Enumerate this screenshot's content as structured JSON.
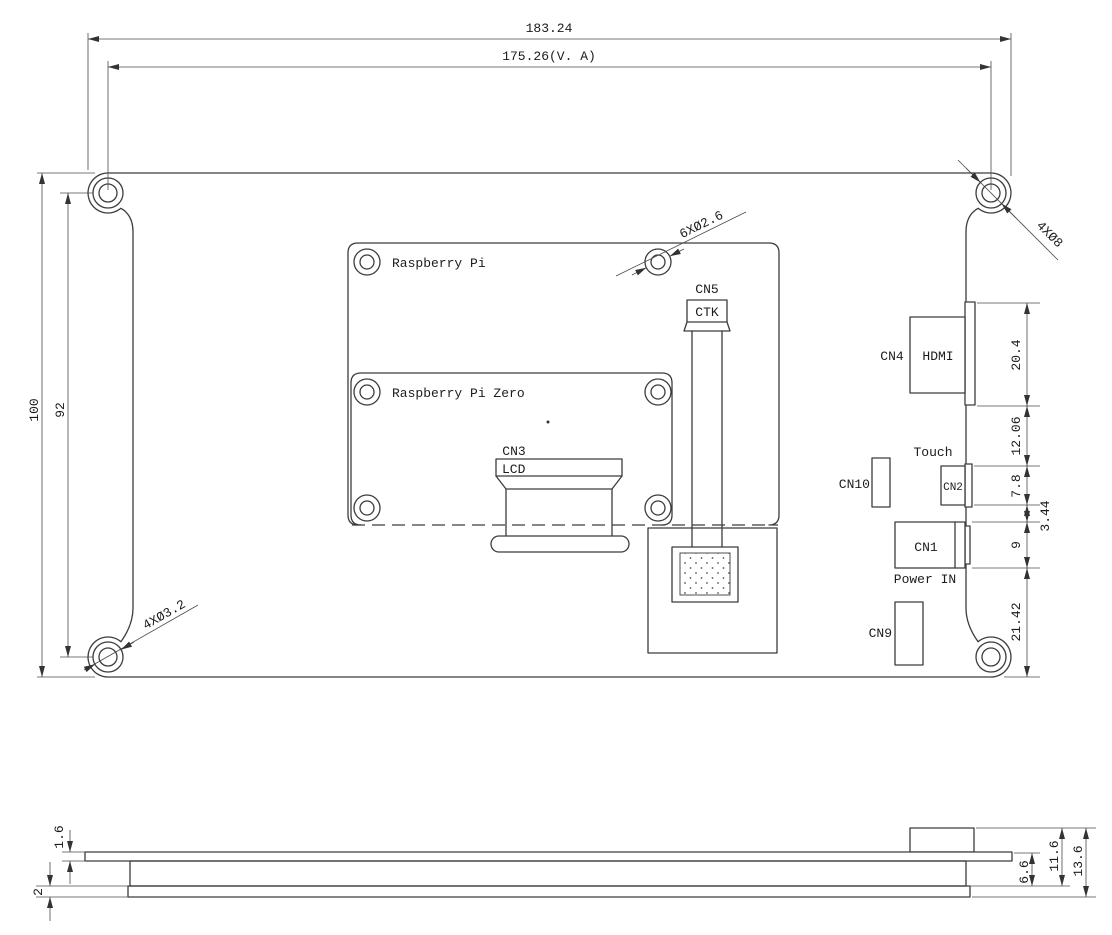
{
  "drawing_type": "LCD display board mechanical drawing, rear view and side view",
  "top_view": {
    "dim_overall_width": "183.24",
    "dim_va_width": "175.26(V. A)",
    "dim_overall_height": "100",
    "dim_hole_span": "92",
    "callout_corner_pads": "4XØ8",
    "callout_small_holes": "6XØ2.6",
    "callout_mount_holes": "4XØ3.2",
    "label_rpi": "Raspberry Pi",
    "label_rpi_zero": "Raspberry Pi Zero",
    "cn5": "CN5",
    "ctk": "CTK",
    "cn3": "CN3",
    "lcd": "LCD",
    "cn4": "CN4",
    "hdmi": "HDMI",
    "touch": "Touch",
    "cn10": "CN10",
    "cn2": "CN2",
    "cn1": "CN1",
    "power_in": "Power IN",
    "cn9": "CN9",
    "dim_hdmi_height": "20.4",
    "dim_hdmi_to_cn2": "12.06",
    "dim_cn2_height": "7.8",
    "dim_cn2_to_cn1": "3.44",
    "dim_cn1_height": "9",
    "dim_cn1_to_edge": "21.42"
  },
  "side_view": {
    "dim_pcb_thickness": "1.6",
    "dim_bottom_layer": "2",
    "dim_stack": "6.6",
    "dim_with_connector": "11.6",
    "dim_total": "13.6"
  },
  "colors": {
    "line": "#3c3c3c",
    "background": "#ffffff"
  }
}
